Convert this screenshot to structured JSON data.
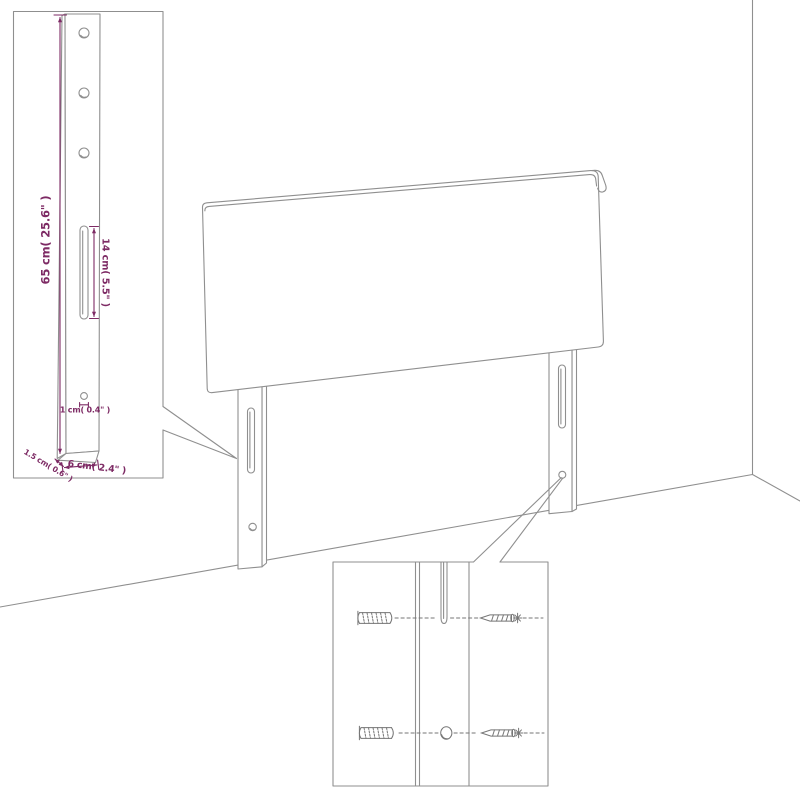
{
  "title": "headboard-assembly-diagram",
  "colors": {
    "background": "#ffffff",
    "line_gray": "#8f8f8f",
    "hardware_gray": "#767676",
    "dimension_purple": "#7d2a64"
  },
  "dims": {
    "height": "65 cm( 25.6\" )",
    "slot": "14 cm( 5.5\" )",
    "hole": "1 cm( 0.4\" )",
    "edge": "1.5 cm( 0.6\" )",
    "width": "6 cm( 2.4\" )"
  },
  "icons": {
    "headboard": "headboard-panel",
    "leg": "mounting-leg",
    "wall_plug": "wall-plug-icon",
    "screw": "screw-icon",
    "pilot_hole": "pilot-hole",
    "slot": "keyhole-slot"
  }
}
